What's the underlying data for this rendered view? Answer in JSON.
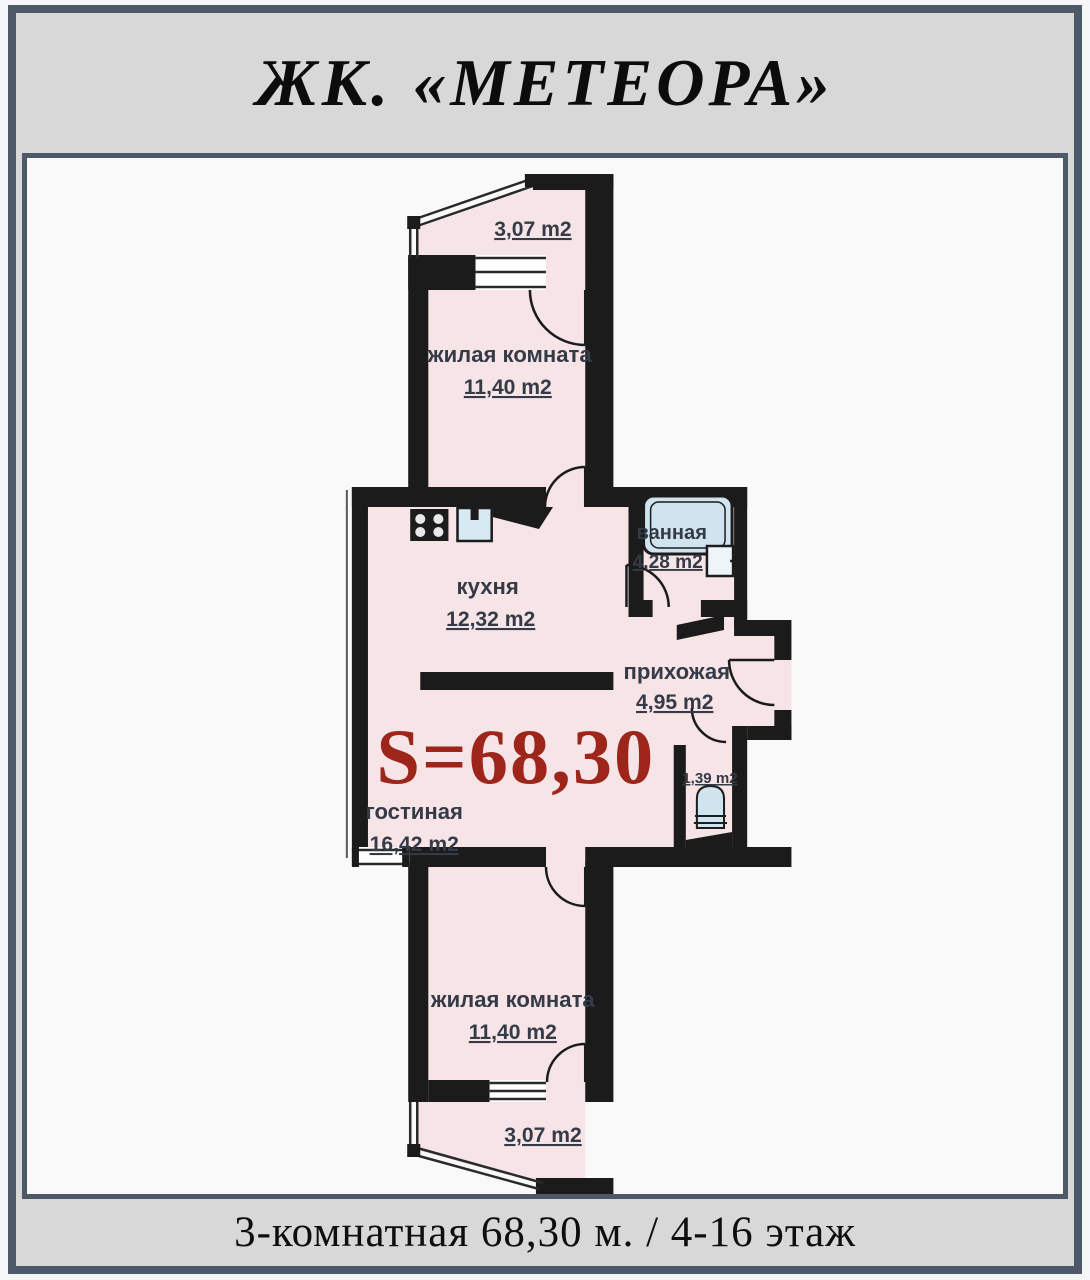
{
  "header": {
    "title": "ЖК. «МЕТЕОРА»"
  },
  "plan": {
    "total_area": "S=68,30",
    "rooms": {
      "balcony_top": {
        "area": "3,07 m2"
      },
      "bedroom_top": {
        "name": "жилая комната",
        "area": "11,40 m2"
      },
      "kitchen": {
        "name": "кухня",
        "area": "12,32 m2"
      },
      "bathroom": {
        "name": "ванная",
        "area": "4,28 m2"
      },
      "hallway": {
        "name": "прихожая",
        "area": "4,95 m2"
      },
      "wc": {
        "area": "1,39 m2"
      },
      "living_room": {
        "name": "гостиная",
        "area": "16,42 m2"
      },
      "bedroom_bottom": {
        "name": "жилая комната",
        "area": "11,40 m2"
      },
      "balcony_bottom": {
        "area": "3,07 m2"
      }
    },
    "colors": {
      "room_fill": "#f6e4e7",
      "wall": "#1b1b1b",
      "fixture_blue": "#cfe4ef",
      "accent_red": "#9e2519",
      "label": "#343b47",
      "frame": "#4d5966",
      "band_bg": "#d8d8d8"
    }
  },
  "footer": {
    "caption": "3-комнатная 68,30 м. / 4-16 этаж"
  }
}
